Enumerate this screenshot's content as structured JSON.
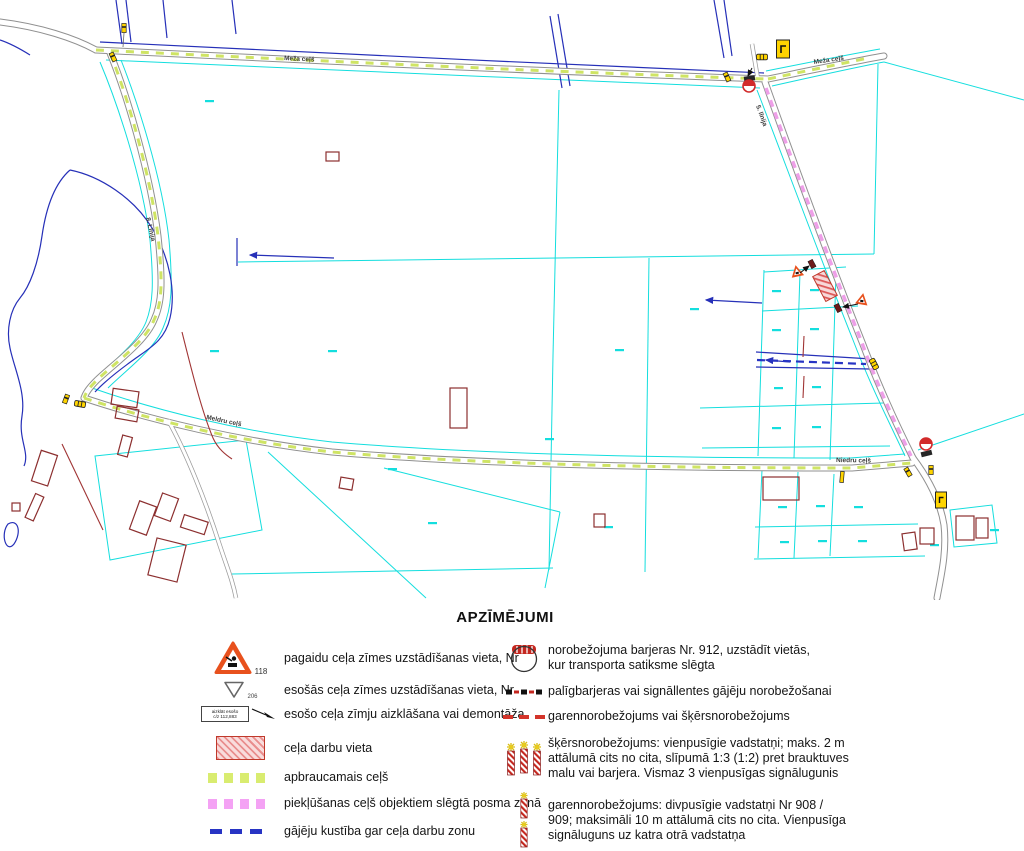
{
  "map": {
    "road_labels": [
      {
        "text": "Meža ceļš"
      },
      {
        "text": "Meža ceļš"
      },
      {
        "text": "8. Līnija"
      },
      {
        "text": "5. līnija"
      },
      {
        "text": "Meldru ceļš"
      },
      {
        "text": "Niedru ceļš"
      }
    ]
  },
  "legend": {
    "title": "APZĪMĒJUMI",
    "left": [
      {
        "number": "118",
        "label": "pagaidu ceļa zīmes uzstādīšanas vieta, Nr"
      },
      {
        "number": "206",
        "label": "esošās ceļa zīmes uzstādīšanas vieta, Nr"
      },
      {
        "box_text": "aizklāt esošo\nc/z 112,883",
        "label": "esošo ceļa zīmju aizklāšana vai demontāža"
      },
      {
        "label": "ceļa darbu vieta"
      },
      {
        "label": "apbraucamais ceļš"
      },
      {
        "label": "piekļūšanas ceļš objektiem slēgtā posma zonā"
      },
      {
        "label": "gājēju kustība gar ceļa darbu zonu"
      }
    ],
    "right": [
      {
        "label": "norobežojuma barjeras Nr. 912, uzstādīt vietās,\nkur transporta satiksme slēgta"
      },
      {
        "label": "palīgbarjeras vai signāllentes gājēju norobežošanai"
      },
      {
        "label": "garennorobežojums vai šķērsnorobežojums"
      },
      {
        "label": "šķērsnorobežojums: vienpusīgie vadstatņi; maks. 2 m\nattālumā cits no cita, slīpumā 1:3 (1:2) pret brauktuves\nmalu vai barjera. Vismaz 3 vienpusīgas signālugunis"
      },
      {
        "label": "garennorobežojums: divpusīgie vadstatņi Nr 908 /\n909; maksimāli 10 m attālumā cits no cita. Vienpusīga\nsignāluguns uz katra otrā vadstatņa"
      }
    ]
  },
  "colors": {
    "detour_green": "#d9ec70",
    "access_magenta": "#f4a2f4",
    "pedestrian_blue": "#2734c4",
    "works_red": "#d03a3a",
    "barrier_red": "#c4271f",
    "parcel_cyan": "#14dede",
    "water_blue": "#2630b8",
    "building_brown": "#8c2f2f",
    "sign_yellow": "#ffd400"
  }
}
